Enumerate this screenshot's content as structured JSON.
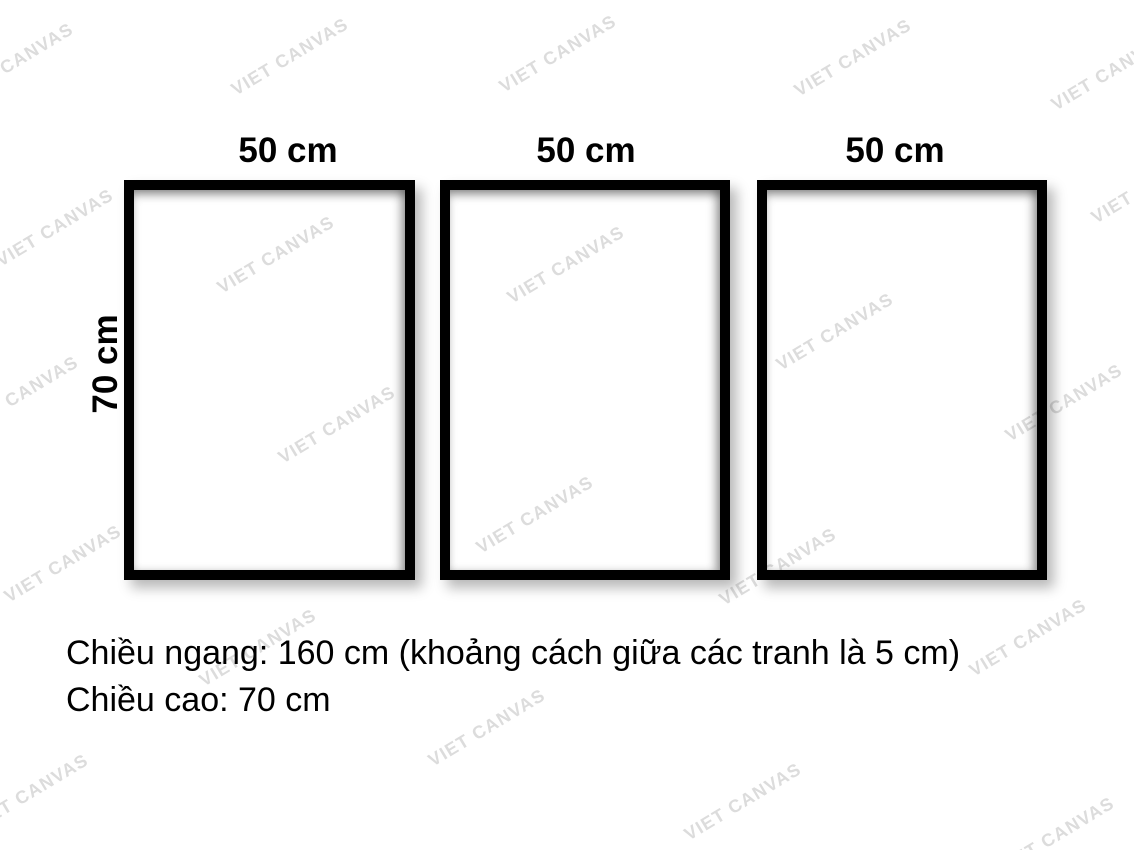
{
  "diagram": {
    "frames": [
      {
        "width_label": "50 cm"
      },
      {
        "width_label": "50 cm"
      },
      {
        "width_label": "50 cm"
      }
    ],
    "height_label": "70 cm"
  },
  "caption": {
    "line1": "Chiều ngang: 160 cm (khoảng cách giữa các tranh là 5 cm)",
    "line2": "Chiều cao: 70 cm"
  },
  "watermark": {
    "text": "VIET CANVAS",
    "color": "#dcdcdc",
    "angle_deg": -31,
    "positions": [
      [
        15,
        62
      ],
      [
        290,
        57
      ],
      [
        558,
        54
      ],
      [
        853,
        58
      ],
      [
        1110,
        72
      ],
      [
        55,
        228
      ],
      [
        276,
        255
      ],
      [
        566,
        265
      ],
      [
        1150,
        185
      ],
      [
        835,
        332
      ],
      [
        20,
        395
      ],
      [
        337,
        425
      ],
      [
        1064,
        403
      ],
      [
        535,
        515
      ],
      [
        63,
        564
      ],
      [
        778,
        567
      ],
      [
        258,
        648
      ],
      [
        1028,
        638
      ],
      [
        487,
        728
      ],
      [
        30,
        793
      ],
      [
        743,
        802
      ],
      [
        1056,
        836
      ]
    ]
  },
  "colors": {
    "background": "#ffffff",
    "frame_border": "#000000",
    "text": "#000000"
  }
}
